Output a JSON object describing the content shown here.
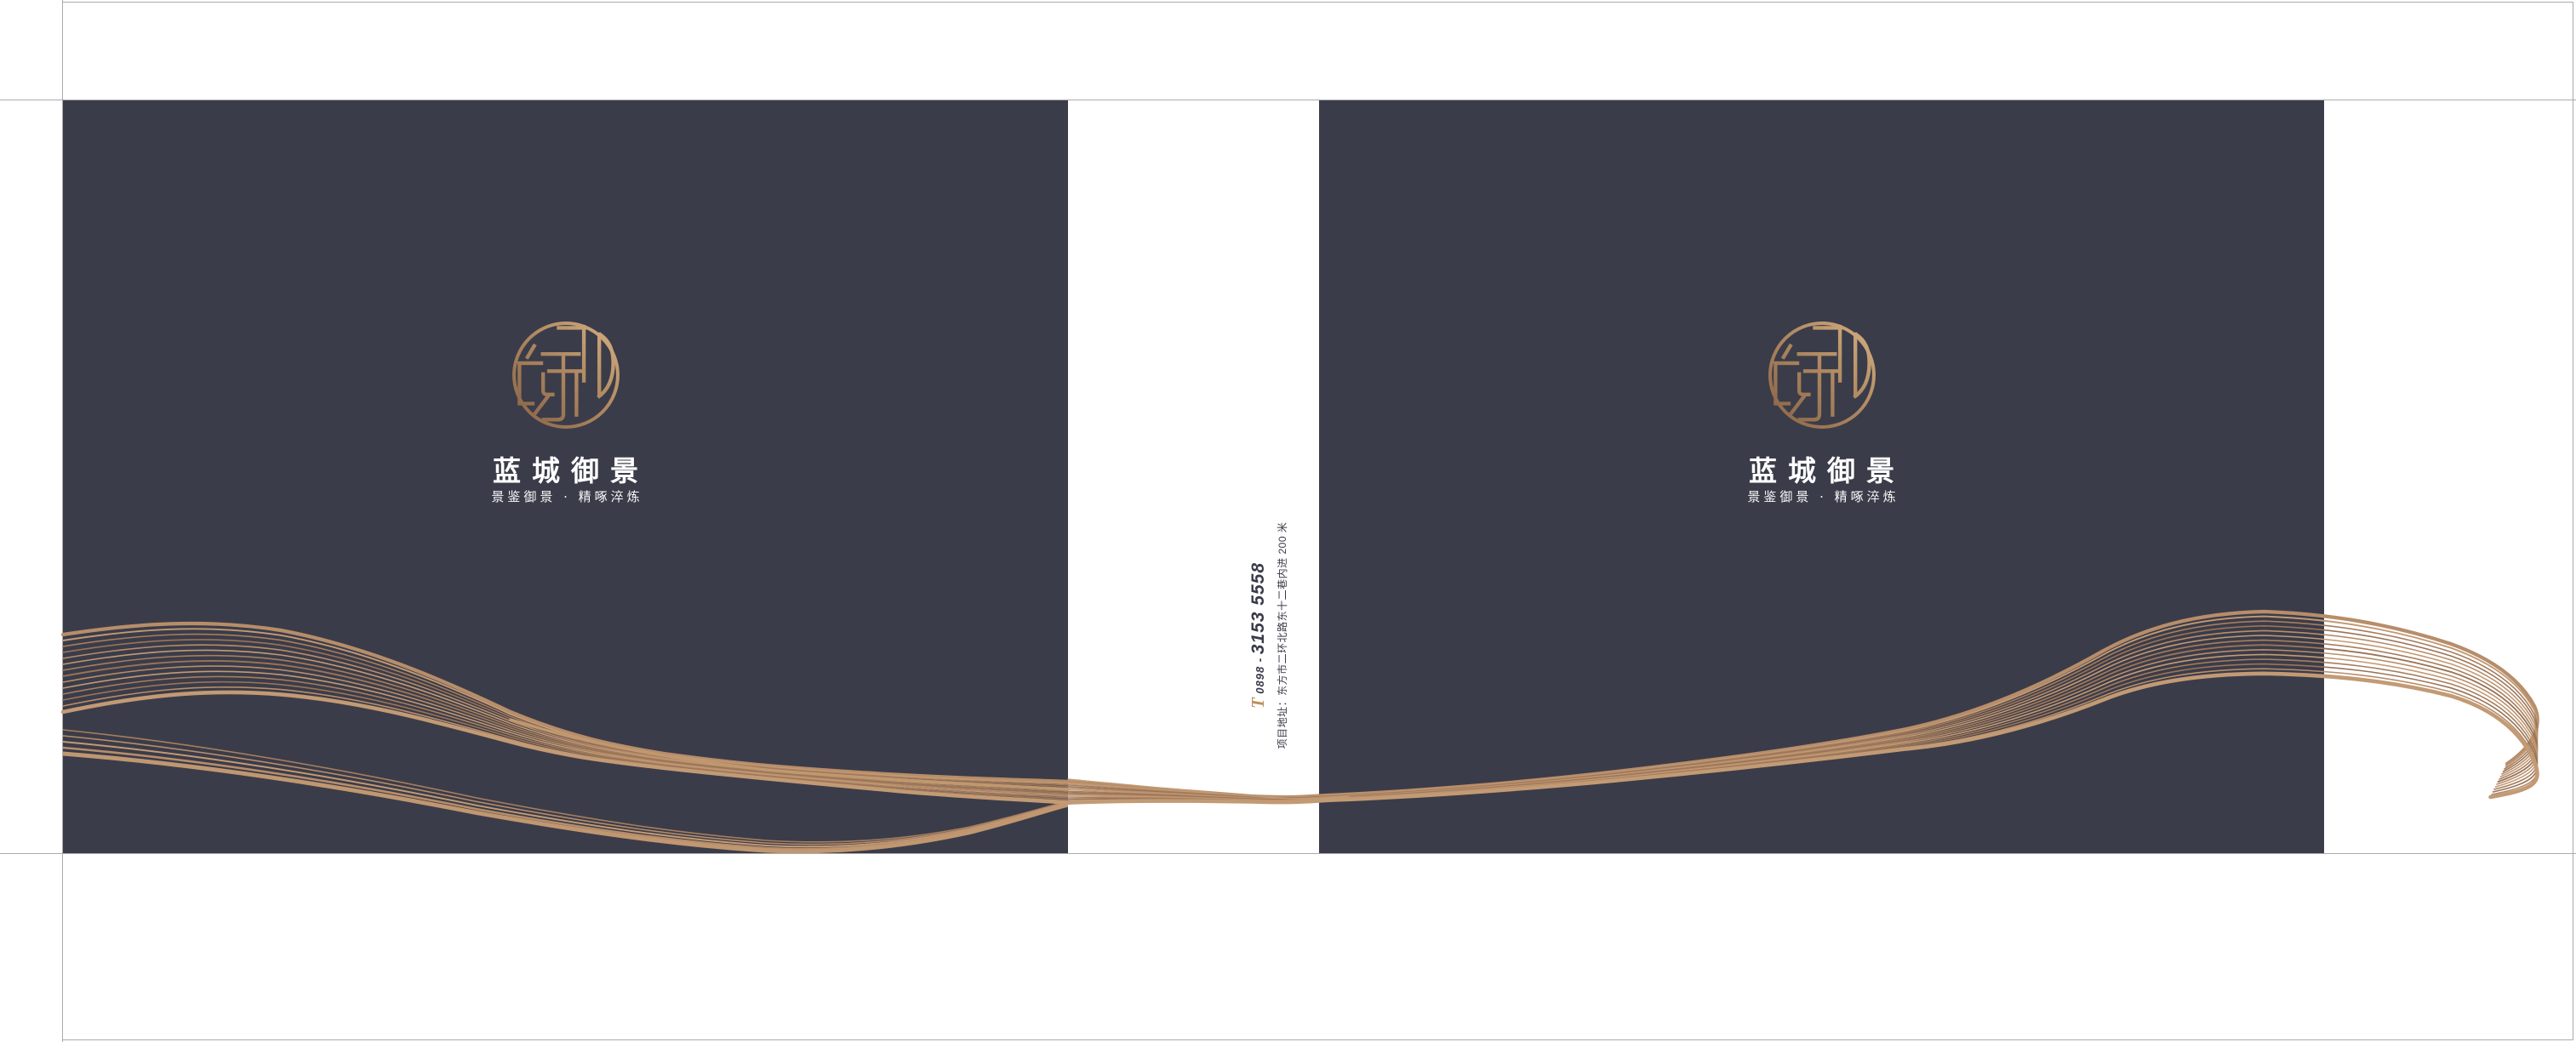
{
  "cover": {
    "brand": "蓝城御景",
    "tagline": "景鉴御景 · 精啄淬炼"
  },
  "spine": {
    "phone_icon": "T",
    "phone_prefix": "0898",
    "phone_separator": "-",
    "phone_number": "3153 5558",
    "address": "项目地址：东方市二环北路东十二巷内进 200 米"
  },
  "colors": {
    "panel_navy": "#3b3c49",
    "gold": "#bd9059",
    "gold_light": "#d4ad80",
    "gold_dark": "#8a6548",
    "text_white": "#ffffff",
    "guide_gray": "#aaabac",
    "spine_ink": "#3a3b49",
    "wave_palette": [
      "#b78d6a",
      "#c29a74",
      "#a67e5e",
      "#997459"
    ]
  }
}
